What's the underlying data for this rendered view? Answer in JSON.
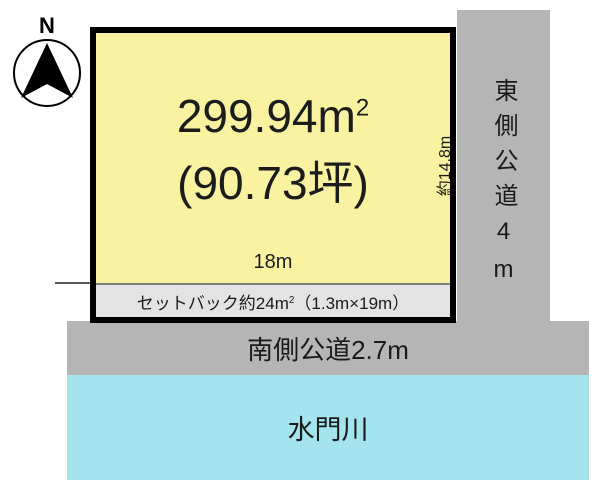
{
  "compass": {
    "north_label": "N"
  },
  "plot": {
    "area_main": "299.94m",
    "area_sup": "2",
    "area_tsubo": "(90.73坪)",
    "frontage_label": "18m",
    "depth_label": "約14.8m",
    "setback_prefix": "セットバック約24m",
    "setback_sup": "2",
    "setback_suffix": "（1.3m×19m）"
  },
  "roads": {
    "east_label": "東側公道4m",
    "south_label": "南側公道2.7m"
  },
  "river": {
    "label": "水門川"
  },
  "colors": {
    "plot_fill": "#f9f2a0",
    "road_fill": "#b5b5b5",
    "setback_fill": "#e3e3e3",
    "river_fill": "#a3e4ef",
    "border": "#000000"
  }
}
